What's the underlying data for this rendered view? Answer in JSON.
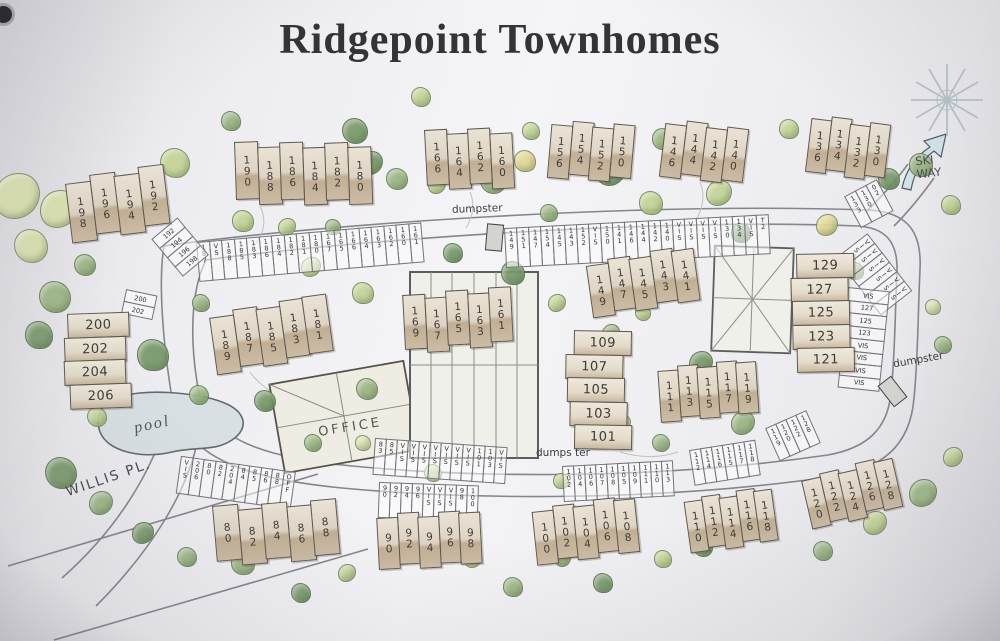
{
  "title": "Ridgepoint Townhomes",
  "labels": {
    "pool": "pool",
    "office": "OFFICE",
    "willis_pl": "WILLIS PL.",
    "ski_way": "SKI\nWAY",
    "dumpster_top": "dumpster",
    "dumpster_bottom": "dumps ter",
    "dumpster_right": "dumpster"
  },
  "colors": {
    "paper": "#f4f3f6",
    "building_fill": "#ded4c3",
    "building_shade": "#c1ae94",
    "outline": "#5e584f",
    "road": "#85858b",
    "pool_water": "#d8e0e3",
    "arrow_fill": "#d4e3e9",
    "tree_palette": [
      "#9cb584",
      "#c3d496",
      "#78996b",
      "#dbe2af",
      "#e3d795"
    ]
  },
  "buildings": [
    {
      "units": [
        "198",
        "196",
        "194",
        "192"
      ],
      "x": 64,
      "y": 176,
      "rot": -7,
      "uw": 26,
      "uh": 60,
      "dir": "v",
      "stagger": [
        8,
        2,
        6,
        0
      ]
    },
    {
      "units": [
        "190",
        "188",
        "186",
        "184",
        "182",
        "180"
      ],
      "x": 234,
      "y": 142,
      "rot": -2,
      "uw": 24,
      "uh": 58,
      "dir": "v",
      "stagger": [
        0,
        6,
        2,
        8,
        4,
        9
      ]
    },
    {
      "units": [
        "166",
        "164",
        "162",
        "160"
      ],
      "x": 424,
      "y": 130,
      "rot": -3,
      "uw": 23,
      "uh": 56,
      "dir": "v",
      "stagger": [
        0,
        5,
        1,
        7
      ]
    },
    {
      "units": [
        "156",
        "154",
        "152",
        "150"
      ],
      "x": 552,
      "y": 118,
      "rot": 5,
      "uw": 22,
      "uh": 54,
      "dir": "v",
      "stagger": [
        6,
        1,
        5,
        0
      ]
    },
    {
      "units": [
        "146",
        "144",
        "142",
        "140"
      ],
      "x": 666,
      "y": 118,
      "rot": 7,
      "uw": 22,
      "uh": 54,
      "dir": "v",
      "stagger": [
        5,
        0,
        4,
        1
      ]
    },
    {
      "units": [
        "136",
        "134",
        "132",
        "130"
      ],
      "x": 812,
      "y": 114,
      "rot": 7,
      "uw": 21,
      "uh": 54,
      "dir": "v",
      "stagger": [
        4,
        0,
        5,
        1
      ]
    },
    {
      "units": [
        "189",
        "187",
        "185",
        "183",
        "181"
      ],
      "x": 208,
      "y": 310,
      "rot": -8,
      "uw": 25,
      "uh": 58,
      "dir": "v",
      "stagger": [
        8,
        3,
        6,
        1,
        0
      ]
    },
    {
      "units": [
        "169",
        "167",
        "165",
        "163",
        "161"
      ],
      "x": 402,
      "y": 292,
      "rot": -3,
      "uw": 23,
      "uh": 55,
      "dir": "v",
      "stagger": [
        3,
        7,
        1,
        5,
        0
      ]
    },
    {
      "units": [
        "149",
        "147",
        "145",
        "143",
        "141"
      ],
      "x": 585,
      "y": 260,
      "rot": -8,
      "uw": 23,
      "uh": 53,
      "dir": "v",
      "stagger": [
        6,
        2,
        5,
        0,
        3
      ]
    },
    {
      "units": [
        "111",
        "113",
        "115",
        "117",
        "119"
      ],
      "x": 657,
      "y": 366,
      "rot": -4,
      "uw": 21,
      "uh": 52,
      "dir": "v",
      "stagger": [
        5,
        1,
        4,
        0,
        2
      ]
    },
    {
      "units": [
        "80",
        "82",
        "84",
        "86",
        "88"
      ],
      "x": 212,
      "y": 506,
      "rot": -5,
      "uw": 26,
      "uh": 56,
      "dir": "v",
      "stagger": [
        0,
        6,
        2,
        7,
        3
      ]
    },
    {
      "units": [
        "90",
        "92",
        "94",
        "96",
        "98"
      ],
      "x": 376,
      "y": 514,
      "rot": -3,
      "uw": 22,
      "uh": 52,
      "dir": "v",
      "stagger": [
        4,
        0,
        5,
        1,
        3
      ]
    },
    {
      "units": [
        "100",
        "102",
        "104",
        "106",
        "108"
      ],
      "x": 531,
      "y": 506,
      "rot": -6,
      "uw": 22,
      "uh": 54,
      "dir": "v",
      "stagger": [
        6,
        2,
        5,
        0,
        3
      ]
    },
    {
      "units": [
        "110",
        "112",
        "114",
        "116",
        "118"
      ],
      "x": 683,
      "y": 498,
      "rot": -8,
      "uw": 19,
      "uh": 52,
      "dir": "v",
      "stagger": [
        4,
        1,
        5,
        0,
        3
      ]
    },
    {
      "units": [
        "120",
        "122",
        "124",
        "126",
        "128"
      ],
      "x": 800,
      "y": 476,
      "rot": -13,
      "uw": 20,
      "uh": 50,
      "dir": "v",
      "stagger": [
        5,
        2,
        6,
        0,
        3
      ]
    },
    {
      "units": [
        "200",
        "202",
        "204",
        "206"
      ],
      "x": 62,
      "y": 314,
      "rot": -2,
      "uw": 62,
      "uh": 25,
      "dir": "h",
      "stagger": [
        5,
        1,
        0,
        5
      ]
    },
    {
      "units": [
        "109",
        "107",
        "105",
        "103",
        "101"
      ],
      "x": 566,
      "y": 330,
      "rot": 1,
      "uw": 58,
      "uh": 25,
      "dir": "h",
      "stagger": [
        8,
        0,
        2,
        5,
        10
      ]
    },
    {
      "units": [
        "129",
        "127",
        "125",
        "123",
        "121"
      ],
      "x": 790,
      "y": 254,
      "rot": -1,
      "uw": 58,
      "uh": 25,
      "dir": "h",
      "stagger": [
        6,
        0,
        1,
        1,
        5
      ]
    }
  ],
  "parking": [
    {
      "x": 197,
      "y": 242,
      "rot": -5,
      "sw": 13.5,
      "sh": 40,
      "dir": "r",
      "stalls": [
        "187",
        "VS",
        "188",
        "185",
        "183",
        "186",
        "184",
        "182",
        "181",
        "180",
        "167",
        "165",
        "166",
        "164",
        "163",
        "162",
        "160",
        "161"
      ]
    },
    {
      "x": 505,
      "y": 228,
      "rot": -3,
      "sw": 13,
      "sh": 40,
      "dir": "r",
      "stalls": [
        "149",
        "151",
        "147",
        "154",
        "145",
        "143",
        "152",
        "VIS",
        "150",
        "141",
        "146",
        "144",
        "142",
        "140",
        "VIS",
        "VIS",
        "VIS",
        "VIS",
        "130",
        "134",
        "VIS",
        "T2"
      ]
    },
    {
      "x": 845,
      "y": 196,
      "rot": -28,
      "sw": 13,
      "sh": 36,
      "dir": "r",
      "stalls": [
        "133",
        "130",
        "02"
      ]
    },
    {
      "x": 868,
      "y": 234,
      "rot": 52,
      "sw": 13,
      "sh": 40,
      "dir": "r",
      "stalls": [
        "VIS",
        "VIS",
        "VIS",
        "VIS",
        "VIS",
        "VIS"
      ]
    },
    {
      "x": 848,
      "y": 288,
      "rot": 6,
      "sw": 42,
      "sh": 13.5,
      "dir": "v",
      "stalls": [
        "VIS",
        "127",
        "125",
        "123",
        "VIS",
        "VIS",
        "VIS",
        "VIS"
      ]
    },
    {
      "x": 376,
      "y": 438,
      "rot": 4,
      "sw": 12,
      "sh": 37,
      "dir": "r",
      "stalls": [
        "83",
        "85",
        "VIS",
        "VIS",
        "VIS",
        "VIS",
        "VIS",
        "VIS",
        "VIS",
        "101",
        "103",
        "VIS"
      ]
    },
    {
      "x": 182,
      "y": 456,
      "rot": 8,
      "sw": 12.5,
      "sh": 38,
      "dir": "r",
      "stalls": [
        "VIS",
        "206",
        "80",
        "82",
        "204",
        "84",
        "85",
        "86",
        "88",
        "OFF"
      ]
    },
    {
      "x": 380,
      "y": 482,
      "rot": 2,
      "sw": 12,
      "sh": 36,
      "dir": "r",
      "stalls": [
        "90",
        "92",
        "94",
        "96",
        "VIS",
        "VIS",
        "VIS",
        "98",
        "100"
      ]
    },
    {
      "x": 563,
      "y": 466,
      "rot": -3,
      "sw": 12,
      "sh": 36,
      "dir": "r",
      "stalls": [
        "102",
        "104",
        "106",
        "107",
        "108",
        "105",
        "109",
        "111",
        "110",
        "113"
      ]
    },
    {
      "x": 690,
      "y": 450,
      "rot": -9,
      "sw": 12,
      "sh": 36,
      "dir": "r",
      "stalls": [
        "112",
        "114",
        "116",
        "115",
        "117",
        "118"
      ]
    },
    {
      "x": 766,
      "y": 428,
      "rot": -24,
      "sw": 12,
      "sh": 36,
      "dir": "r",
      "stalls": [
        "119",
        "120",
        "122",
        "128"
      ]
    },
    {
      "x": 126,
      "y": 290,
      "rot": 12,
      "sw": 32,
      "sh": 13,
      "dir": "v",
      "stalls": [
        "200",
        "202"
      ]
    },
    {
      "x": 152,
      "y": 240,
      "rot": -40,
      "sw": 34,
      "sh": 13,
      "dir": "v",
      "stalls": [
        "192",
        "194",
        "196",
        "198"
      ]
    }
  ],
  "dumpsters": [
    {
      "x": 486,
      "y": 224,
      "rot": 5
    },
    {
      "x": 884,
      "y": 378,
      "rot": -38
    }
  ],
  "trees": [
    [
      16,
      195,
      22,
      3
    ],
    [
      30,
      245,
      16,
      3
    ],
    [
      58,
      208,
      18,
      3
    ],
    [
      54,
      296,
      15,
      0
    ],
    [
      38,
      334,
      13,
      2
    ],
    [
      84,
      264,
      10,
      0
    ],
    [
      174,
      162,
      14,
      1
    ],
    [
      230,
      120,
      9,
      0
    ],
    [
      354,
      130,
      12,
      2
    ],
    [
      370,
      162,
      11,
      2
    ],
    [
      420,
      96,
      9,
      1
    ],
    [
      242,
      220,
      10,
      1
    ],
    [
      286,
      226,
      8,
      1
    ],
    [
      332,
      226,
      7,
      0
    ],
    [
      396,
      178,
      10,
      0
    ],
    [
      436,
      184,
      8,
      1
    ],
    [
      492,
      180,
      12,
      0
    ],
    [
      524,
      160,
      10,
      4
    ],
    [
      548,
      212,
      8,
      0
    ],
    [
      610,
      170,
      14,
      2
    ],
    [
      650,
      202,
      11,
      1
    ],
    [
      662,
      138,
      10,
      0
    ],
    [
      718,
      192,
      12,
      1
    ],
    [
      788,
      128,
      9,
      1
    ],
    [
      740,
      232,
      9,
      2
    ],
    [
      826,
      224,
      10,
      4
    ],
    [
      888,
      178,
      10,
      2
    ],
    [
      920,
      164,
      11,
      0
    ],
    [
      950,
      204,
      9,
      1
    ],
    [
      932,
      306,
      7,
      3
    ],
    [
      942,
      344,
      8,
      0
    ],
    [
      854,
      270,
      8,
      0
    ],
    [
      310,
      266,
      9,
      1
    ],
    [
      362,
      292,
      10,
      1
    ],
    [
      200,
      302,
      8,
      0
    ],
    [
      152,
      354,
      15,
      2
    ],
    [
      198,
      394,
      9,
      0
    ],
    [
      232,
      350,
      8,
      1
    ],
    [
      264,
      400,
      10,
      2
    ],
    [
      366,
      388,
      10,
      0
    ],
    [
      452,
      252,
      9,
      2
    ],
    [
      512,
      272,
      11,
      2
    ],
    [
      556,
      302,
      8,
      1
    ],
    [
      610,
      332,
      8,
      0
    ],
    [
      642,
      312,
      7,
      1
    ],
    [
      700,
      362,
      11,
      2
    ],
    [
      742,
      422,
      11,
      0
    ],
    [
      660,
      442,
      8,
      0
    ],
    [
      622,
      422,
      7,
      1
    ],
    [
      580,
      392,
      6,
      1
    ],
    [
      60,
      472,
      15,
      2
    ],
    [
      100,
      502,
      11,
      0
    ],
    [
      142,
      532,
      10,
      2
    ],
    [
      186,
      556,
      9,
      0
    ],
    [
      242,
      562,
      11,
      0
    ],
    [
      300,
      592,
      9,
      2
    ],
    [
      346,
      572,
      8,
      1
    ],
    [
      430,
      546,
      11,
      2
    ],
    [
      472,
      558,
      8,
      1
    ],
    [
      512,
      586,
      9,
      0
    ],
    [
      562,
      558,
      7,
      0
    ],
    [
      602,
      582,
      9,
      2
    ],
    [
      662,
      558,
      8,
      1
    ],
    [
      702,
      546,
      9,
      2
    ],
    [
      762,
      522,
      8,
      0
    ],
    [
      822,
      550,
      9,
      0
    ],
    [
      874,
      522,
      11,
      1
    ],
    [
      922,
      492,
      13,
      0
    ],
    [
      952,
      456,
      9,
      1
    ],
    [
      432,
      472,
      8,
      1
    ],
    [
      362,
      442,
      7,
      3
    ],
    [
      312,
      442,
      8,
      0
    ],
    [
      96,
      416,
      9,
      1
    ],
    [
      480,
      302,
      9,
      2
    ],
    [
      478,
      332,
      8,
      0
    ],
    [
      560,
      480,
      7,
      1
    ],
    [
      530,
      130,
      8,
      1
    ]
  ]
}
